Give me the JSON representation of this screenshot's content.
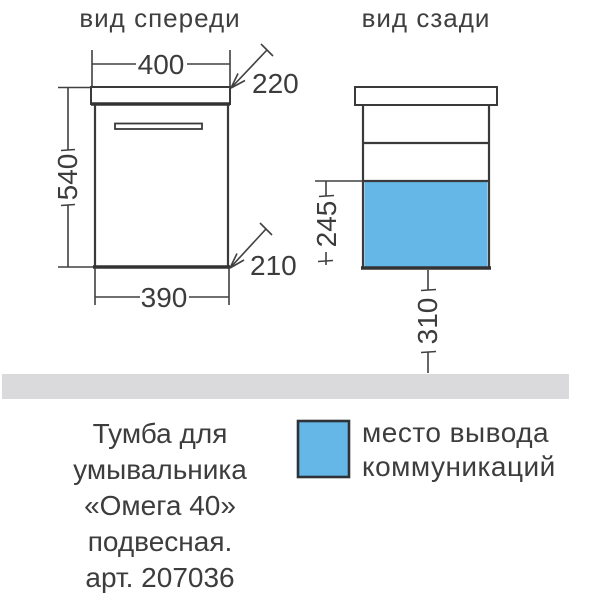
{
  "front_view": {
    "title": "вид спереди",
    "dim_width_top": "400",
    "dim_depth_top": "220",
    "dim_height": "540",
    "dim_depth_bottom": "210",
    "dim_width_bottom": "390"
  },
  "back_view": {
    "title": "вид сзади",
    "dim_comm_zone_height": "245",
    "dim_comm_zone_offset": "310"
  },
  "caption": {
    "lines": [
      "Тумба для",
      "умывальника",
      "«Омега 40»",
      "подвесная.",
      "арт. 207036"
    ]
  },
  "legend": {
    "line1": "место вывода",
    "line2": "коммуникаций"
  },
  "colors": {
    "comm_zone_blue": "#64b7e6",
    "floor_gray": "#dadadc",
    "line_dark": "#3f3f3f"
  }
}
